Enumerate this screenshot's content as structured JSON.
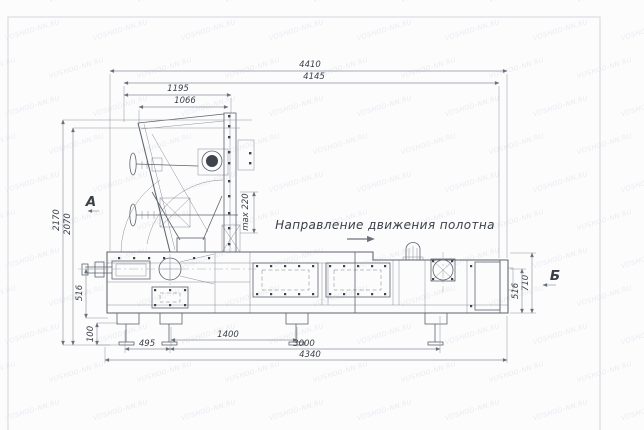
{
  "drawing": {
    "type": "machine-assembly-side-view",
    "direction_note": "Направление движения полотна",
    "view_labels": {
      "a": "А",
      "b": "Б"
    }
  },
  "dims": {
    "overall_width": "4410",
    "body_width": "4145",
    "hopper_width_outer": "1195",
    "hopper_width_inner": "1066",
    "overall_height": "2170",
    "hopper_height": "2070",
    "left_axis_height": "516",
    "foot_height": "100",
    "right_end_height": "710",
    "right_axis_height": "516",
    "leg_offset": "495",
    "leg_spacing": "1400",
    "frame_length": "3000",
    "base_length": "4340",
    "gap_max": "max 220"
  },
  "watermark": {
    "text": "VOSHOD-NN.RU"
  },
  "colors": {
    "line": "#5d636c",
    "dim_line": "#8e939c",
    "text": "#3b4048",
    "background": "#fcfcfd",
    "border": "#d3d6db",
    "watermark": "#8a92a8"
  }
}
